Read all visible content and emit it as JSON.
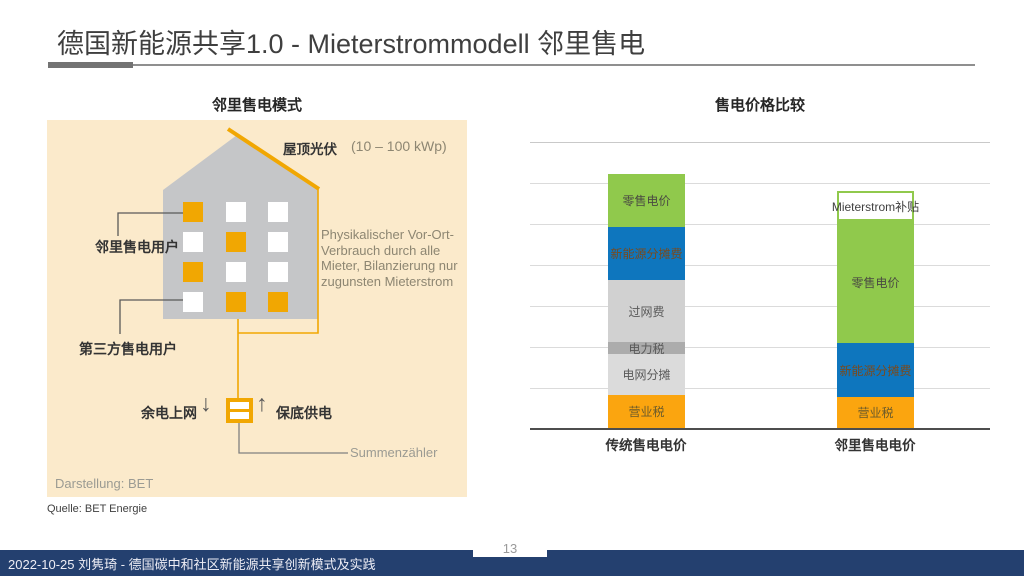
{
  "slide": {
    "title": "德国新能源共享1.0 - Mieterstrommodell 邻里售电",
    "source": "Quelle: BET Energie",
    "footer": "2022-10-25 刘隽琦 - 德国碳中和社区新能源共享创新模式及实践",
    "page_number": "13"
  },
  "colors": {
    "accent_orange": "#F1A702",
    "panel_beige": "#FBEACB",
    "house_gray": "#C5C6C8",
    "chart_green": "#90C94C",
    "chart_blue": "#0E76BE",
    "chart_orange": "#FBA50F",
    "footer_navy": "#24406F"
  },
  "diagram": {
    "title": "邻里售电模式",
    "roof_label": "屋顶光伏",
    "roof_capacity": "(10 – 100 kWp)",
    "note_lines": [
      "Physikalischer Vor-Ort-",
      "Verbrauch durch alle",
      "Mieter, Bilanzierung nur",
      "zugunsten Mieterstrom"
    ],
    "label_neighbor_user": "邻里售电用户",
    "label_third_party_user": "第三方售电用户",
    "label_feed_in": "余电上网",
    "label_backup_supply": "保底供电",
    "arrow_down": "↓",
    "arrow_up": "↑",
    "meter_label": "Summenzähler",
    "credit": "Darstellung: BET",
    "windows": [
      [
        "orange",
        "white",
        "white"
      ],
      [
        "white",
        "orange",
        "white"
      ],
      [
        "orange",
        "white",
        "white"
      ],
      [
        "white",
        "orange",
        "orange"
      ]
    ]
  },
  "chart_data": {
    "type": "bar",
    "stacked": true,
    "title": "售电价格比较",
    "categories": [
      "传统售电电价",
      "邻里售电电价"
    ],
    "value_unit": "gridline intervals (no numeric axis labels shown)",
    "gridline_count": 7,
    "legend": "none",
    "bars": [
      {
        "category": "传统售电电价",
        "segments": [
          {
            "label": "营业税",
            "value": 0.8,
            "height_px": 33,
            "color": "#FBA50F",
            "text_color": "#6B5B2B"
          },
          {
            "label": "电网分摊",
            "value": 1.0,
            "height_px": 41,
            "color": "#DBDBDB",
            "text_color": "#595959"
          },
          {
            "label": "电力税",
            "value": 0.3,
            "height_px": 12,
            "color": "#ACACAC",
            "text_color": "#595959"
          },
          {
            "label": "过网费",
            "value": 1.5,
            "height_px": 62,
            "color": "#D1D1D1",
            "text_color": "#595959"
          },
          {
            "label": "新能源分摊费",
            "value": 1.3,
            "height_px": 53,
            "color": "#0E76BE",
            "text_color": "#7A4A1D"
          },
          {
            "label": "零售电价",
            "value": 1.3,
            "height_px": 53,
            "color": "#90C94C",
            "text_color": "#4A4A42"
          }
        ]
      },
      {
        "category": "邻里售电电价",
        "segments": [
          {
            "label": "营业税",
            "value": 0.75,
            "height_px": 31,
            "color": "#FBA50F",
            "text_color": "#6B5B2B"
          },
          {
            "label": "新能源分摊费",
            "value": 1.3,
            "height_px": 54,
            "color": "#0E76BE",
            "text_color": "#7A4A1D"
          },
          {
            "label": "零售电价",
            "value": 3.0,
            "height_px": 122,
            "color": "#90C94C",
            "text_color": "#4A4A42"
          },
          {
            "label": "Mieterstrom补贴",
            "value": 0.75,
            "height_px": 30,
            "color": "#FFFFFF",
            "text_color": "#3F3F3F",
            "border_color": "#90C94C"
          }
        ]
      }
    ]
  }
}
